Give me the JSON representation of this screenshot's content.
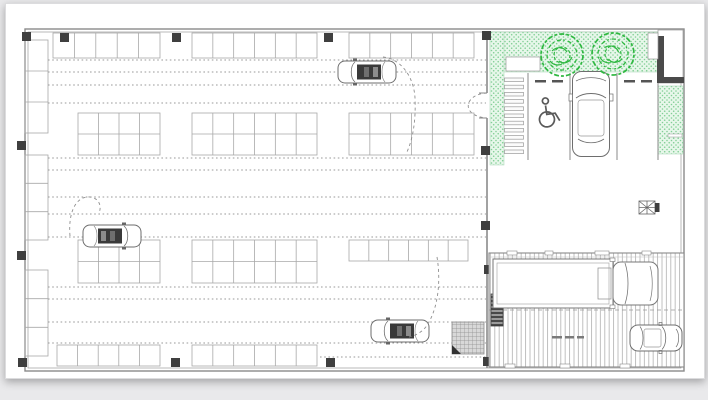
{
  "canvas": {
    "background": "#e9e9eb",
    "page_background": "#ffffff"
  },
  "colors": {
    "wall": "#8a8a8a",
    "stall_line": "#a8a8a8",
    "dotted_line": "#9a9a9a",
    "column": "#3f3f3f",
    "green_fill": "#e7f7ea",
    "green_dot": "#84cf97",
    "tree_stroke": "#2eb840",
    "ramp_hatch": "#b8b8b8",
    "car_detail": "#3a3a3a",
    "grate_fill": "#d8d8d8"
  },
  "floor_plan": {
    "outer_wall": {
      "x": 25,
      "y": 29,
      "w": 659,
      "h": 342
    },
    "stall_rows": [
      {
        "x": 53,
        "y": 33,
        "w": 107,
        "h": 25,
        "cols": 5,
        "double": false
      },
      {
        "x": 192,
        "y": 33,
        "w": 125,
        "h": 25,
        "cols": 6,
        "double": false
      },
      {
        "x": 349,
        "y": 33,
        "w": 125,
        "h": 25,
        "cols": 6,
        "double": false
      },
      {
        "x": 78,
        "y": 113,
        "w": 82,
        "h": 42,
        "cols": 4,
        "double": true
      },
      {
        "x": 192,
        "y": 113,
        "w": 125,
        "h": 42,
        "cols": 6,
        "double": true
      },
      {
        "x": 349,
        "y": 113,
        "w": 125,
        "h": 42,
        "cols": 6,
        "double": true
      },
      {
        "x": 78,
        "y": 240,
        "w": 82,
        "h": 43,
        "cols": 4,
        "double": true
      },
      {
        "x": 192,
        "y": 240,
        "w": 125,
        "h": 43,
        "cols": 6,
        "double": true
      },
      {
        "x": 349,
        "y": 240,
        "w": 119,
        "h": 21,
        "cols": 6,
        "double": false
      },
      {
        "x": 57,
        "y": 345,
        "w": 103,
        "h": 21,
        "cols": 5,
        "double": false
      },
      {
        "x": 192,
        "y": 345,
        "w": 125,
        "h": 21,
        "cols": 6,
        "double": false
      }
    ],
    "side_stall_columns": [
      {
        "x": 25,
        "y": 40,
        "w": 23,
        "h": 93,
        "cells": 3
      },
      {
        "x": 25,
        "y": 155,
        "w": 23,
        "h": 85,
        "cells": 3
      },
      {
        "x": 25,
        "y": 270,
        "w": 23,
        "h": 86,
        "cells": 3
      }
    ],
    "aisle_dotted_lines": [
      {
        "y": 60,
        "x1": 48,
        "x2": 486
      },
      {
        "y": 72,
        "x1": 48,
        "x2": 486
      },
      {
        "y": 85,
        "x1": 48,
        "x2": 486
      },
      {
        "y": 103,
        "x1": 48,
        "x2": 486
      },
      {
        "y": 158,
        "x1": 48,
        "x2": 486
      },
      {
        "y": 170,
        "x1": 48,
        "x2": 486
      },
      {
        "y": 197,
        "x1": 48,
        "x2": 486
      },
      {
        "y": 214,
        "x1": 48,
        "x2": 486
      },
      {
        "y": 237,
        "x1": 48,
        "x2": 486
      },
      {
        "y": 287,
        "x1": 48,
        "x2": 486
      },
      {
        "y": 299,
        "x1": 48,
        "x2": 486
      },
      {
        "y": 322,
        "x1": 48,
        "x2": 486
      },
      {
        "y": 343,
        "x1": 48,
        "x2": 486
      },
      {
        "y": 357,
        "x1": 320,
        "x2": 486
      }
    ],
    "structural_columns": [
      [
        22,
        32
      ],
      [
        60,
        33
      ],
      [
        172,
        33
      ],
      [
        324,
        33
      ],
      [
        482,
        31
      ],
      [
        18,
        358
      ],
      [
        171,
        358
      ],
      [
        326,
        358
      ],
      [
        483,
        357
      ],
      [
        17,
        141
      ],
      [
        17,
        251
      ],
      [
        481,
        146
      ],
      [
        481,
        221
      ],
      [
        484,
        265
      ]
    ]
  },
  "entrance_court": {
    "stall_dividers_x": [
      528,
      570,
      617,
      658
    ],
    "stall_top_y": 73,
    "stall_bottom_y": 160,
    "wheel_stops": {
      "y": 80,
      "w": 11,
      "h": 2.5,
      "offsets": [
        7,
        24
      ]
    },
    "crosswalk": {
      "x": 504.5,
      "y": 78,
      "w": 19,
      "bar_h": 3.6,
      "gap": 3.6,
      "bars": 11
    },
    "trees": [
      {
        "cx": 562,
        "cy": 55
      },
      {
        "cx": 613,
        "cy": 54
      }
    ],
    "accessible_icon": "wheelchair-icon",
    "parked_car_orientation": "vertical"
  },
  "ramp": {
    "x": 489,
    "y": 253,
    "w": 195,
    "h": 114,
    "vehicles": [
      "box-truck",
      "car"
    ],
    "annotation_marks": 3
  },
  "symbols": {
    "vent_fan": {
      "x": 639,
      "y": 201,
      "icon": "vent-fan-icon"
    },
    "floor_grate": {
      "x": 452,
      "y": 322,
      "w": 32,
      "h": 32
    },
    "stair_block": {
      "x": 491,
      "y": 294,
      "w": 12,
      "h": 32
    }
  }
}
